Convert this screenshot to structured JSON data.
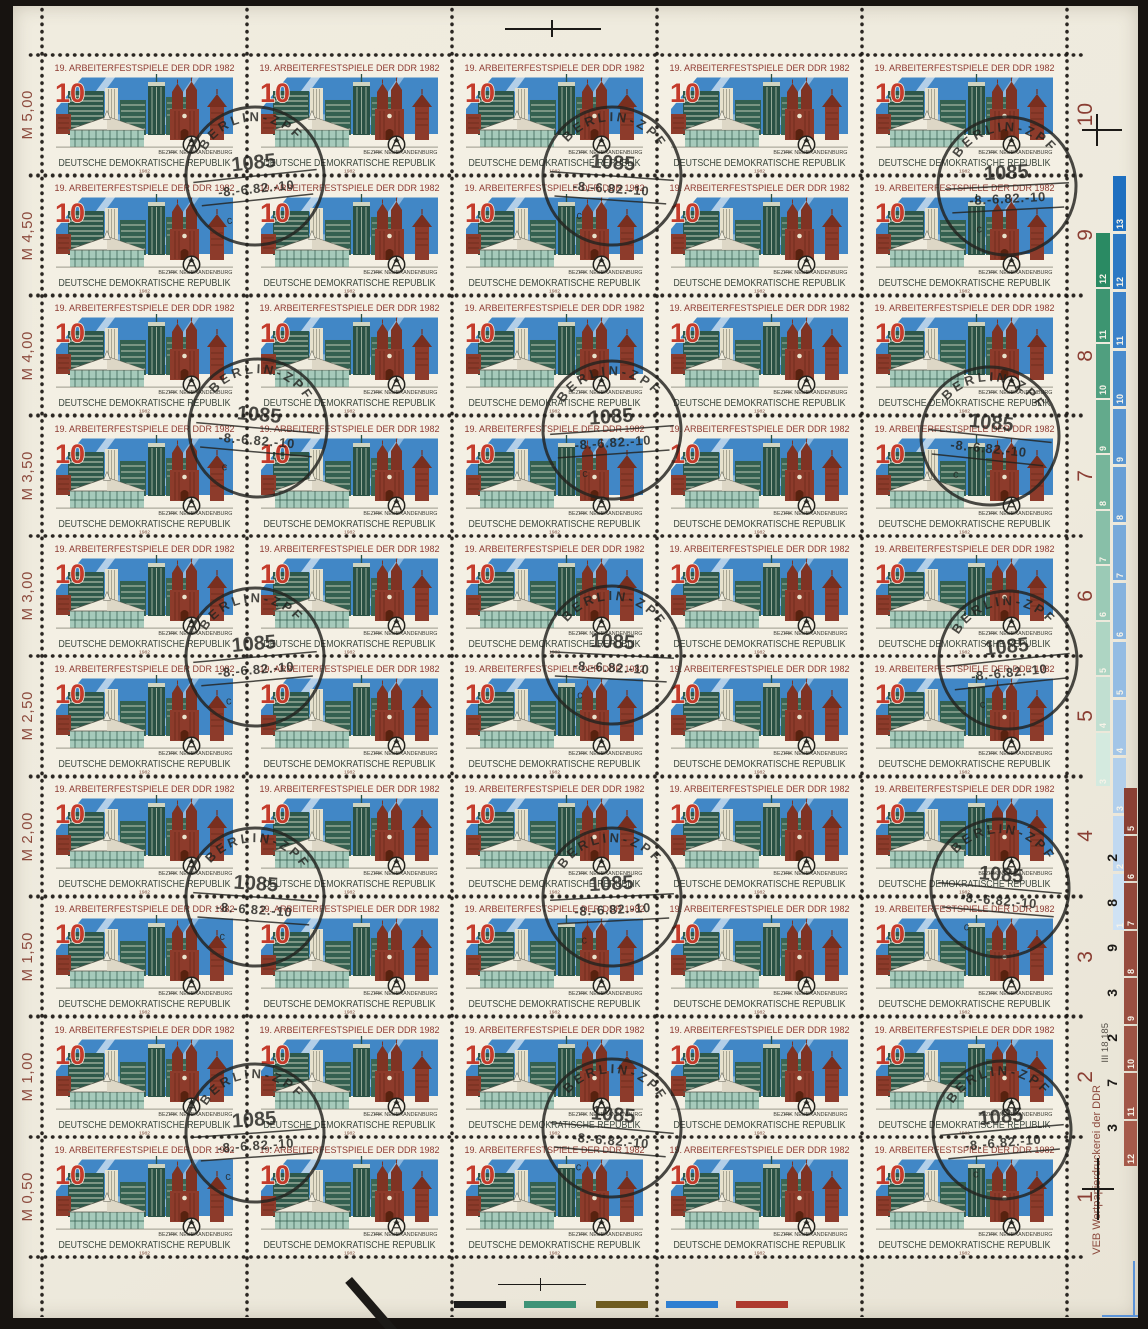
{
  "stamp": {
    "title": "19. ARBEITERFESTSPIELE DER DDR 1982",
    "denomination": "10",
    "district_label": "BEZIRK NEUBRANDENBURG",
    "country": "DEUTSCHE DEMOKRATISCHE REPUBLIK",
    "year": "1982",
    "grid": {
      "columns": 5,
      "rows": 10,
      "total": 50
    }
  },
  "left_margin": {
    "row_values": [
      "M 5,00",
      "M 4,50",
      "M 4,00",
      "M 3,50",
      "M 3,00",
      "M 2,50",
      "M 2,00",
      "M 1,50",
      "M 1,00",
      "M 0,50"
    ]
  },
  "right_margin": {
    "row_numbers": [
      "10",
      "9",
      "8",
      "7",
      "6",
      "5",
      "4",
      "3",
      "2",
      "1"
    ],
    "printer_imprint": "VEB Wertpapierdruckerei der DDR",
    "plate_number": "III 18 185",
    "blue_strip_numbers": [
      "13",
      "12",
      "11",
      "10",
      "9",
      "8",
      "7",
      "6",
      "5",
      "4",
      "3",
      "2",
      "1"
    ],
    "green_strip_numbers": [
      "12",
      "11",
      "10",
      "9",
      "8",
      "7",
      "6",
      "5",
      "4",
      "3"
    ],
    "red_strip_numbers": [
      "5",
      "6",
      "7",
      "8",
      "9",
      "10",
      "11",
      "12"
    ],
    "red_strip_black_digits": [
      "2",
      "8",
      "9",
      "3",
      "2",
      "7",
      "3"
    ]
  },
  "postmark": {
    "town": "BERLIN-ZPF",
    "postcode": "1085",
    "date_line": "-8.-6.82.-10",
    "index_letter": "c",
    "count": 15
  },
  "color_bars": [
    {
      "name": "black",
      "color": "#1c1c1c"
    },
    {
      "name": "green",
      "color": "#3e9377"
    },
    {
      "name": "olive",
      "color": "#6f5c20"
    },
    {
      "name": "blue",
      "color": "#2e7fd1"
    },
    {
      "name": "red",
      "color": "#ae3a2e"
    }
  ],
  "colors": {
    "paper": "#efebdf",
    "stamp_paper": "#f4f0e4",
    "title_red": "#8e3a31",
    "denomination_red": "#c43b2b",
    "sky_blue": "#4187c6",
    "building_green": "#2e584a",
    "brick_red": "#8d3b2b",
    "margin_red": "#8c4a3d",
    "postmark_ink": "#23231f"
  }
}
